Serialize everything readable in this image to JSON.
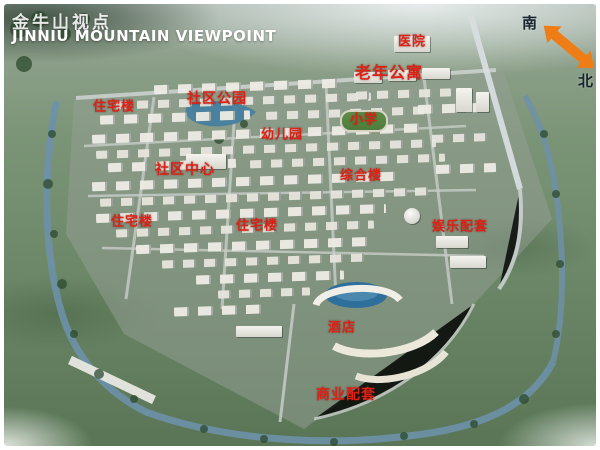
{
  "title": {
    "cn": "金牛山视点",
    "en": "JINNIU MOUNTAIN VIEWPOINT"
  },
  "compass": {
    "south_label": "南",
    "north_label": "北"
  },
  "colors": {
    "label_red": "#dc2115",
    "arrow_orange": "#ee7d15",
    "water_blue": "#6d91a8",
    "pond_blue": "#2e6f9b"
  },
  "labels": [
    {
      "text": "医院",
      "x": 408,
      "y": 38,
      "size": 13
    },
    {
      "text": "老年公寓",
      "x": 385,
      "y": 69,
      "size": 16
    },
    {
      "text": "社区公园",
      "x": 213,
      "y": 95,
      "size": 14
    },
    {
      "text": "住宅楼",
      "x": 110,
      "y": 103,
      "size": 13
    },
    {
      "text": "小学",
      "x": 360,
      "y": 116,
      "size": 13
    },
    {
      "text": "幼儿园",
      "x": 278,
      "y": 131,
      "size": 13
    },
    {
      "text": "社区中心",
      "x": 181,
      "y": 166,
      "size": 14
    },
    {
      "text": "综合楼",
      "x": 357,
      "y": 172,
      "size": 13
    },
    {
      "text": "住宅楼",
      "x": 128,
      "y": 218,
      "size": 13
    },
    {
      "text": "住宅楼",
      "x": 253,
      "y": 222,
      "size": 13
    },
    {
      "text": "娱乐配套",
      "x": 456,
      "y": 223,
      "size": 13
    },
    {
      "text": "酒店",
      "x": 338,
      "y": 324,
      "size": 13
    },
    {
      "text": "商业配套",
      "x": 342,
      "y": 391,
      "size": 14
    }
  ]
}
